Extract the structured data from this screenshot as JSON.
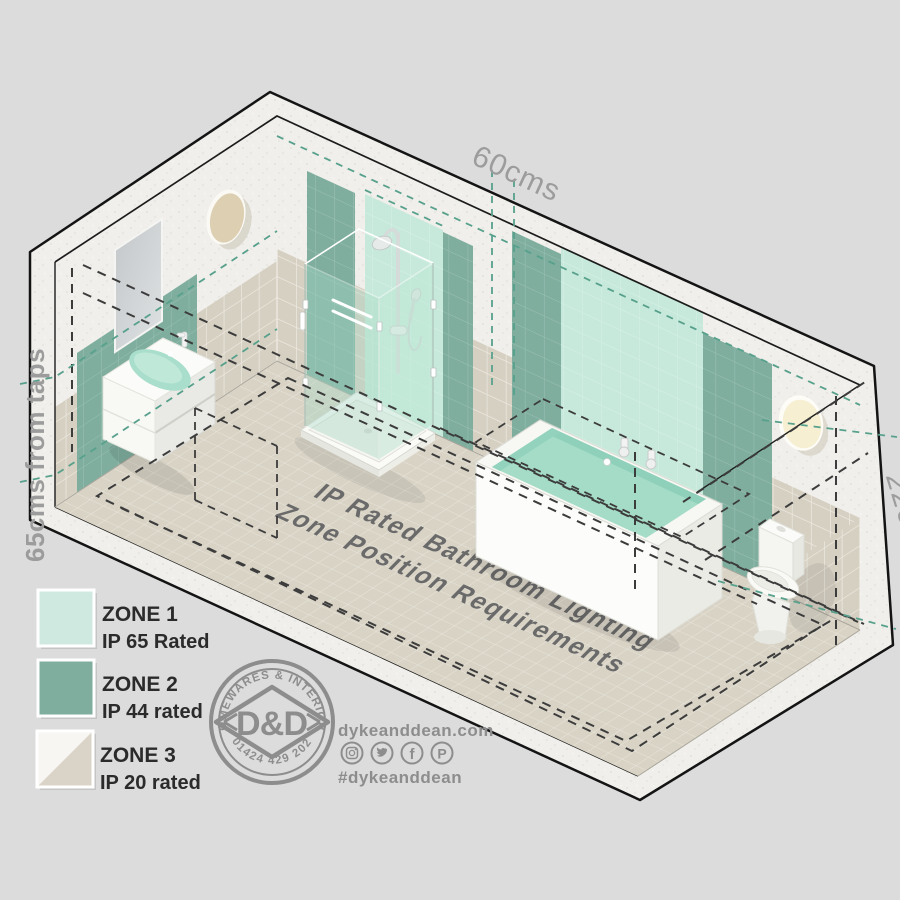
{
  "background_color": "#dcdcdd",
  "scene": {
    "floor_title": {
      "line1": "IP Rated Bathroom Lighting",
      "line2": "Zone Position Requirements"
    },
    "dimension_labels": {
      "top": "60cms",
      "left": "65cms from taps",
      "right": "225cms"
    },
    "fixtures": [
      "wall-light-left",
      "mirror",
      "basin-vanity",
      "shower-enclosure",
      "bathtub",
      "toilet",
      "wall-light-right"
    ],
    "colors": {
      "zone1_mint": "#c7e9db",
      "zone2_green": "#7fae9f",
      "tile_beige": "#d6d0c2",
      "floor": "#d8d3c5",
      "concrete": "#f0efeb",
      "outline": "#141414",
      "zone_dash": "#3c3c3c",
      "measure_dash": "#57a18c",
      "label_gray": "#9c9c9c",
      "floor_text": "#6a6a6a"
    }
  },
  "legend": {
    "items": [
      {
        "zone": "ZONE 1",
        "rating": "IP 65 Rated",
        "swatch": "#cfe9e0"
      },
      {
        "zone": "ZONE 2",
        "rating": "IP 44 rated",
        "swatch": "#7fad9e"
      },
      {
        "zone": "ZONE 3",
        "rating": "IP 20 rated",
        "swatch_top": "#f7f6f3",
        "swatch_bottom": "#d9d4c7"
      }
    ]
  },
  "logo": {
    "arc_top": "HOMEWARES & INTERIORS",
    "arc_bottom": "01424 429 202",
    "monogram": "D&D"
  },
  "footer": {
    "website": "dykeanddean.com",
    "hashtag": "#dykeanddean",
    "social": [
      "instagram-icon",
      "twitter-icon",
      "facebook-icon",
      "pinterest-icon"
    ]
  }
}
